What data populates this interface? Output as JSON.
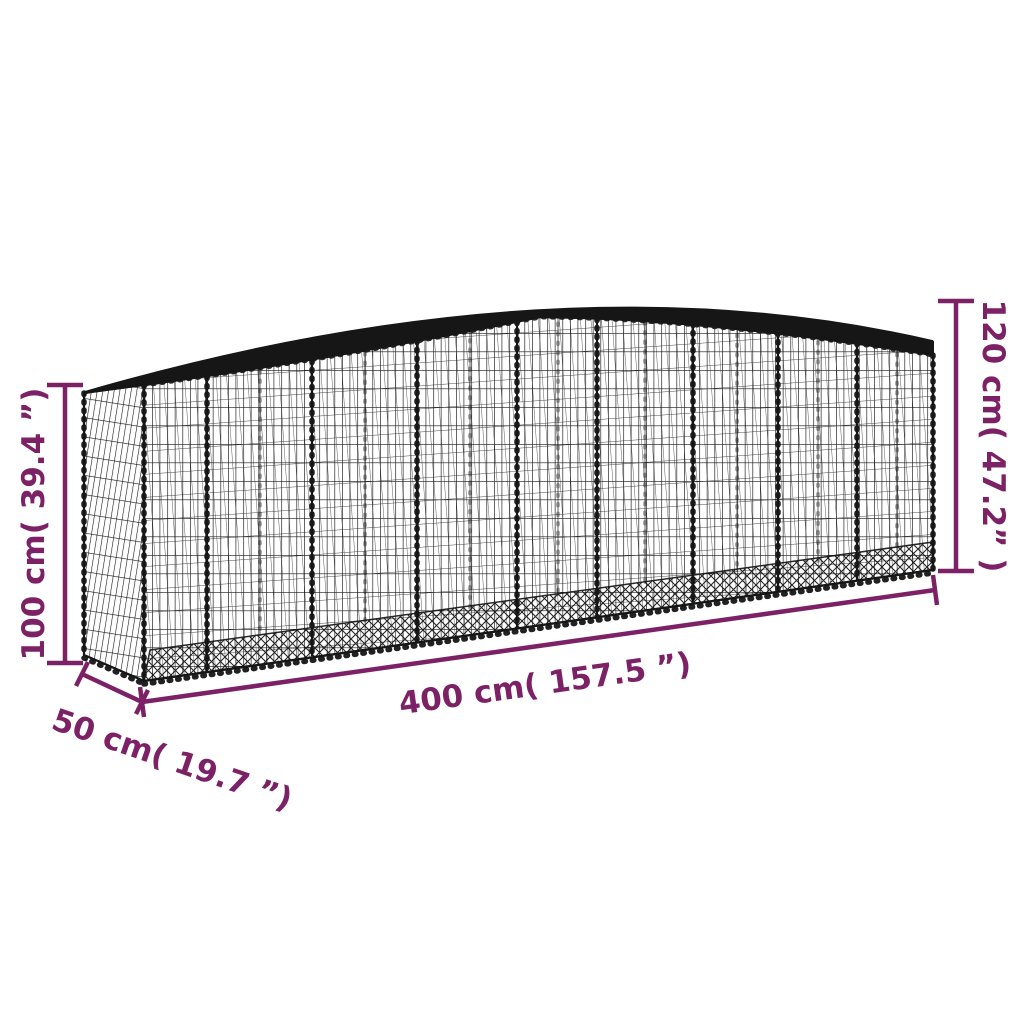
{
  "product_diagram": {
    "background_color": "#ffffff",
    "wire_color": "#161616",
    "accent_color": "#7c2166",
    "illustration": "arched-gabion-wire-mesh-basket"
  },
  "dimensions": {
    "height_left": "100 cm( 39.4 ”)",
    "height_right": "120 cm( 47.2” )",
    "width": "400 cm( 157.5 ”)",
    "depth": "50 cm( 19.7 ”)"
  }
}
